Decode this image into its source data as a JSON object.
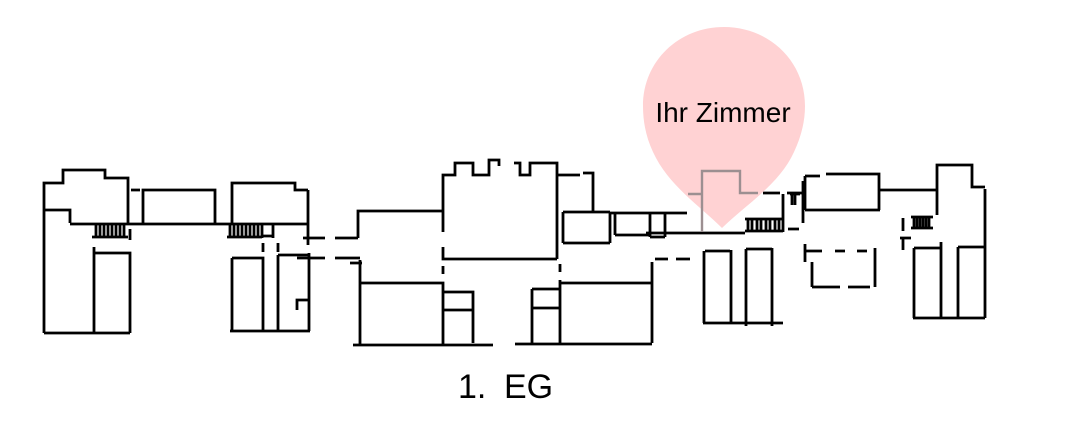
{
  "marker": {
    "label": "Ihr Zimmer"
  },
  "caption": {
    "number": "1.",
    "label": "EG"
  },
  "floor_plan": {
    "description": "hand-drawn ground-floor plan of elongated building complex",
    "stair_count": 4
  },
  "colors": {
    "background": "#ffffff",
    "line": "#000000",
    "pin_fill": "#ffd2d3",
    "marked_room_line": "#9c8f91",
    "text": "#000000"
  }
}
